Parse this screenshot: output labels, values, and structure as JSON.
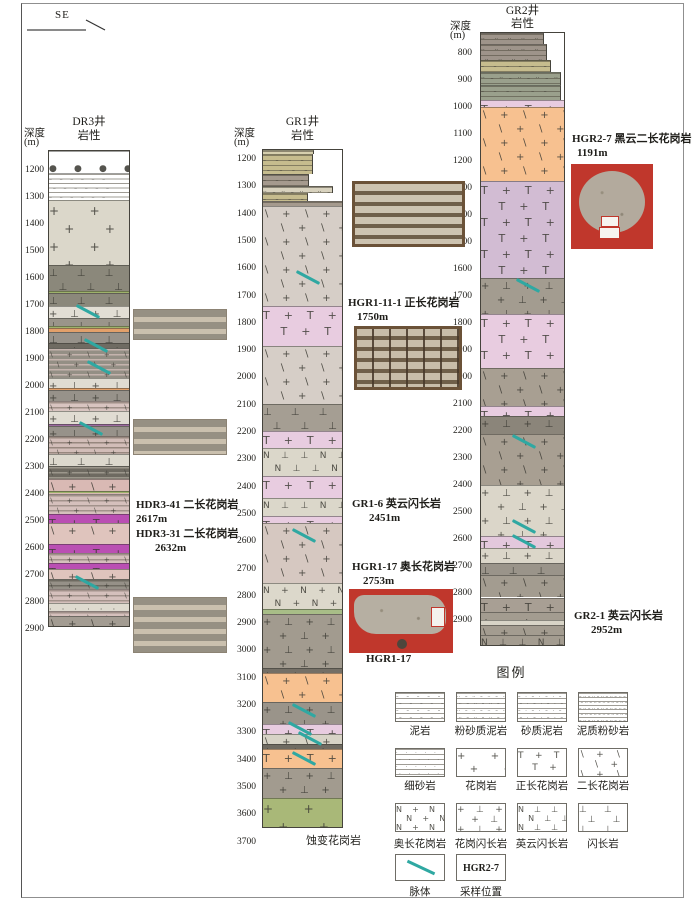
{
  "direction_label": "SE",
  "colors": {
    "vein": "#2fa8a2",
    "magenta": "#ba4fb3",
    "orange_granite": "#f7c190",
    "pink_syenogranite": "#e6cbdf",
    "purple_syenogranite": "#d2bcd3",
    "green_altered": "#a9b878",
    "photo_red": "#c0372c"
  },
  "wells": [
    {
      "name": "DR3井",
      "depth_label": "深度",
      "depth_unit": "(m)",
      "lith_label": "岩性",
      "ticks": [
        1200,
        1300,
        1400,
        1500,
        1600,
        1700,
        1800,
        1900,
        2000,
        2100,
        2200,
        2300,
        2400,
        2500,
        2600,
        2700,
        2800,
        2900
      ],
      "layers": [
        [
          1125,
          1207,
          "dots",
          "#ffffff"
        ],
        [
          1207,
          1307,
          "sedwhite",
          "#ffffff"
        ],
        [
          1307,
          1548,
          "plus",
          "#dbd7ca"
        ],
        [
          1548,
          1645,
          "perp",
          "#8b887b"
        ],
        [
          1645,
          1652,
          "line",
          "#9eb26b"
        ],
        [
          1652,
          1700,
          "perp",
          "#8b887b"
        ],
        [
          1700,
          1744,
          "plusperp",
          "#e2ded4"
        ],
        [
          1744,
          1774,
          "perp",
          "#9a958a"
        ],
        [
          1774,
          1781,
          "line",
          "#9eb26b"
        ],
        [
          1781,
          1796,
          "line",
          "#e2a06a"
        ],
        [
          1796,
          1837,
          "perp",
          "#97928a"
        ],
        [
          1837,
          1856,
          "plusperp",
          "#6f6b62"
        ],
        [
          1856,
          1967,
          "banded",
          "#948f85",
          "#c4b3ad"
        ],
        [
          1967,
          2004,
          "plusperp",
          "#e0dcd2"
        ],
        [
          2004,
          2011,
          "line",
          "#e2a06a"
        ],
        [
          2011,
          2052,
          "plusperp",
          "#97928a"
        ],
        [
          2052,
          2089,
          "banded",
          "#d8c4c0",
          "#a09088"
        ],
        [
          2089,
          2137,
          "plusperp",
          "#e0dcd2"
        ],
        [
          2137,
          2144,
          "line",
          "#9b6a9e"
        ],
        [
          2144,
          2181,
          "plusperp",
          "#97928a"
        ],
        [
          2181,
          2248,
          "banded",
          "#d2bdb8",
          "#97877e"
        ],
        [
          2248,
          2293,
          "perp",
          "#dcd8cd"
        ],
        [
          2293,
          2341,
          "banded",
          "#6e6a61",
          "#9c978c"
        ],
        [
          2341,
          2396,
          "slashplus",
          "#d9b9b4"
        ],
        [
          2385,
          2391,
          "line",
          "#9eb26b"
        ],
        [
          2396,
          2470,
          "banded",
          "#d5c0bc",
          "#a2928b"
        ],
        [
          2470,
          2504,
          "tplus",
          "#ba4fb3"
        ],
        [
          2504,
          2581,
          "slashplus",
          "#dfc4bd"
        ],
        [
          2581,
          2615,
          "tplus",
          "#ba4fb3"
        ],
        [
          2615,
          2652,
          "banded",
          "#d5c0bc",
          "#a2928b"
        ],
        [
          2652,
          2674,
          "tplus",
          "#ba4fb3"
        ],
        [
          2674,
          2711,
          "slashplus",
          "#dfc4bd"
        ],
        [
          2711,
          2748,
          "banded",
          "#969188",
          "#6e6a61"
        ],
        [
          2748,
          2800,
          "banded",
          "#d5c0bc",
          "#a2928b"
        ],
        [
          2800,
          2830,
          "dotgrid",
          "#dedacf"
        ],
        [
          2830,
          2848,
          "banded",
          "#d5c0bc",
          "#a2928b"
        ],
        [
          2848,
          2893,
          "slashplus",
          "#a39c92"
        ]
      ],
      "veins": [
        [
          1718,
          0.32
        ],
        [
          1843,
          0.42
        ],
        [
          1925,
          0.45
        ],
        [
          2152,
          0.35
        ],
        [
          2724,
          0.3
        ]
      ]
    },
    {
      "name": "GR1井",
      "depth_label": "深度",
      "depth_unit": "(m)",
      "lith_label": "岩性",
      "ticks": [
        1200,
        1300,
        1400,
        1500,
        1600,
        1700,
        1800,
        1900,
        2000,
        2100,
        2200,
        2300,
        2400,
        2500,
        2600,
        2700,
        2800,
        2900,
        3000,
        3100,
        3200,
        3300,
        3400,
        3500,
        3600,
        3700
      ],
      "layers": [
        [
          1163,
          1178,
          "seddash",
          "#d6cfae",
          0.63
        ],
        [
          1178,
          1251,
          "seddash",
          "#c6bc8e",
          0.62
        ],
        [
          1251,
          1295,
          "seddash",
          "#a59a8e",
          0.57
        ],
        [
          1295,
          1321,
          "seddotdash",
          "#d8d2be",
          0.87
        ],
        [
          1321,
          1350,
          "seddash",
          "#c6bc8e",
          0.56
        ],
        [
          1350,
          1368,
          "seddash",
          "#a59a8e",
          0.99
        ],
        [
          1368,
          1735,
          "slashplus",
          "#d6cec7"
        ],
        [
          1735,
          1881,
          "tplus",
          "#e8cce0"
        ],
        [
          1881,
          2094,
          "slashplus",
          "#d6cec7"
        ],
        [
          2094,
          2193,
          "perp",
          "#a59e93"
        ],
        [
          2193,
          2255,
          "tplus",
          "#e8cce0"
        ],
        [
          2255,
          2358,
          "nperp",
          "#dbd7ca"
        ],
        [
          2358,
          2438,
          "tplus",
          "#e8cce0"
        ],
        [
          2438,
          2504,
          "nperp",
          "#dbd7ca"
        ],
        [
          2504,
          2530,
          "tplus",
          "#e8cce0"
        ],
        [
          2530,
          2749,
          "slashplus",
          "#d6c8c1"
        ],
        [
          2749,
          2845,
          "nplus",
          "#dcd8cb"
        ],
        [
          2845,
          2863,
          "line",
          "#a8bd87"
        ],
        [
          2863,
          3061,
          "plusperp",
          "#a29b8f"
        ],
        [
          3061,
          3079,
          "perp",
          "#746f66"
        ],
        [
          3079,
          3185,
          "slashplus",
          "#f7c190"
        ],
        [
          3185,
          3266,
          "plusperp",
          "#9a948a"
        ],
        [
          3266,
          3303,
          "tplus",
          "#e8cce0"
        ],
        [
          3303,
          3339,
          "slashplus",
          "#d7d3c6"
        ],
        [
          3339,
          3357,
          "perp",
          "#6f6b62"
        ],
        [
          3357,
          3427,
          "tplus",
          "#f7c190"
        ],
        [
          3427,
          3537,
          "plusperp",
          "#a29b8f"
        ],
        [
          3537,
          3650,
          "plus",
          "#a9b878"
        ]
      ],
      "veins": [
        [
          1630,
          0.4
        ],
        [
          2575,
          0.35
        ],
        [
          3215,
          0.35
        ],
        [
          3280,
          0.3
        ],
        [
          3318,
          0.42
        ],
        [
          3392,
          0.35
        ]
      ]
    },
    {
      "name": "GR2井",
      "depth_label": "深度",
      "depth_unit": "(m)",
      "lith_label": "岩性",
      "ticks": [
        800,
        900,
        1000,
        1100,
        1200,
        1300,
        1400,
        1500,
        1600,
        1700,
        1800,
        1900,
        2000,
        2100,
        2200,
        2300,
        2400,
        2500,
        2600,
        2700,
        2800,
        2900
      ],
      "layers": [
        [
          722,
          763,
          "seddots",
          "#9e948a",
          0.74
        ],
        [
          763,
          822,
          "seddots",
          "#9e948a",
          0.78
        ],
        [
          822,
          865,
          "seddash",
          "#c6bc8e",
          0.82
        ],
        [
          865,
          915,
          "seddotdash",
          "#9aa08c",
          0.94
        ],
        [
          915,
          970,
          "seddash",
          "#9aa08c",
          0.94
        ],
        [
          970,
          996,
          "tplus",
          "#e8cce0"
        ],
        [
          996,
          1270,
          "slashplus",
          "#f7c190"
        ],
        [
          1270,
          1629,
          "tplus",
          "#d2bcd3"
        ],
        [
          1629,
          1762,
          "plusperp",
          "#a39c90"
        ],
        [
          1762,
          1962,
          "tplus",
          "#e8cce0"
        ],
        [
          1962,
          2102,
          "slashplus",
          "#a89f92"
        ],
        [
          2102,
          2139,
          "tplus",
          "#e8cce0"
        ],
        [
          2139,
          2206,
          "plusperp",
          "#8b857a"
        ],
        [
          2206,
          2398,
          "slashplus",
          "#a89f92"
        ],
        [
          2398,
          2587,
          "plusperp",
          "#dbd6c9"
        ],
        [
          2587,
          2628,
          "tplus",
          "#e3c8dc"
        ],
        [
          2628,
          2687,
          "plusperp",
          "#dbd6c9"
        ],
        [
          2687,
          2731,
          "perp",
          "#9a948a"
        ],
        [
          2731,
          2813,
          "slashplus",
          "#a39c90"
        ],
        [
          2813,
          2868,
          "tplus",
          "#a89f94"
        ],
        [
          2868,
          2898,
          "plus",
          "#a39c90"
        ],
        [
          2898,
          2916,
          "dotgrid",
          "#d8d4c7"
        ],
        [
          2916,
          2953,
          "slashplus",
          "#a39c90"
        ],
        [
          2953,
          2998,
          "nperp",
          "#a39c90"
        ]
      ],
      "veins": [
        [
          1655,
          0.4
        ],
        [
          2235,
          0.35
        ],
        [
          2550,
          0.35
        ],
        [
          2605,
          0.35
        ]
      ]
    }
  ],
  "annotations": {
    "hdr3_41": {
      "l1": "HDR3-41  二长花岗岩",
      "l2": "2617m"
    },
    "hdr3_31": {
      "l1": "HDR3-31 二长花岗岩",
      "l2": "2632m"
    },
    "hgr1_11_1": {
      "l1": "HGR1-11-1  正长花岗岩",
      "l2": "1750m"
    },
    "gr1_6": {
      "l1": "GR1-6  英云闪长岩",
      "l2": "2451m"
    },
    "hgr1_17": {
      "l1": "HGR1-17  奥长花岗岩",
      "l2": "2753m"
    },
    "hgr1_17_caption": "HGR1-17",
    "hgr2_7": {
      "l1": "HGR2-7 黑云二长花岗岩",
      "l2": "1191m"
    },
    "gr2_1": {
      "l1": "GR2-1  英云闪长岩",
      "l2": "2952m"
    },
    "altered_granite": "蚀变花岗岩"
  },
  "legend": {
    "title": "图例",
    "items": [
      {
        "label": "泥岩",
        "pattern": "seddash"
      },
      {
        "label": "粉砂质泥岩",
        "pattern": "seddotdash"
      },
      {
        "label": "砂质泥岩",
        "pattern": "seddashdot"
      },
      {
        "label": "泥质粉砂岩",
        "pattern": "sedfine"
      },
      {
        "label": "细砂岩",
        "pattern": "seddot"
      },
      {
        "label": "花岗岩",
        "pattern": "plus"
      },
      {
        "label": "正长花岗岩",
        "pattern": "tplus"
      },
      {
        "label": "二长花岗岩",
        "pattern": "slashplus"
      },
      {
        "label": "奥长花岗岩",
        "pattern": "nplus"
      },
      {
        "label": "花岗闪长岩",
        "pattern": "plusperp"
      },
      {
        "label": "英云闪长岩",
        "pattern": "nperp"
      },
      {
        "label": "闪长岩",
        "pattern": "perp"
      }
    ],
    "vein_item": {
      "label": "脉体"
    },
    "sample_item": {
      "label": "采样位置",
      "box_text": "HGR2-7"
    }
  }
}
